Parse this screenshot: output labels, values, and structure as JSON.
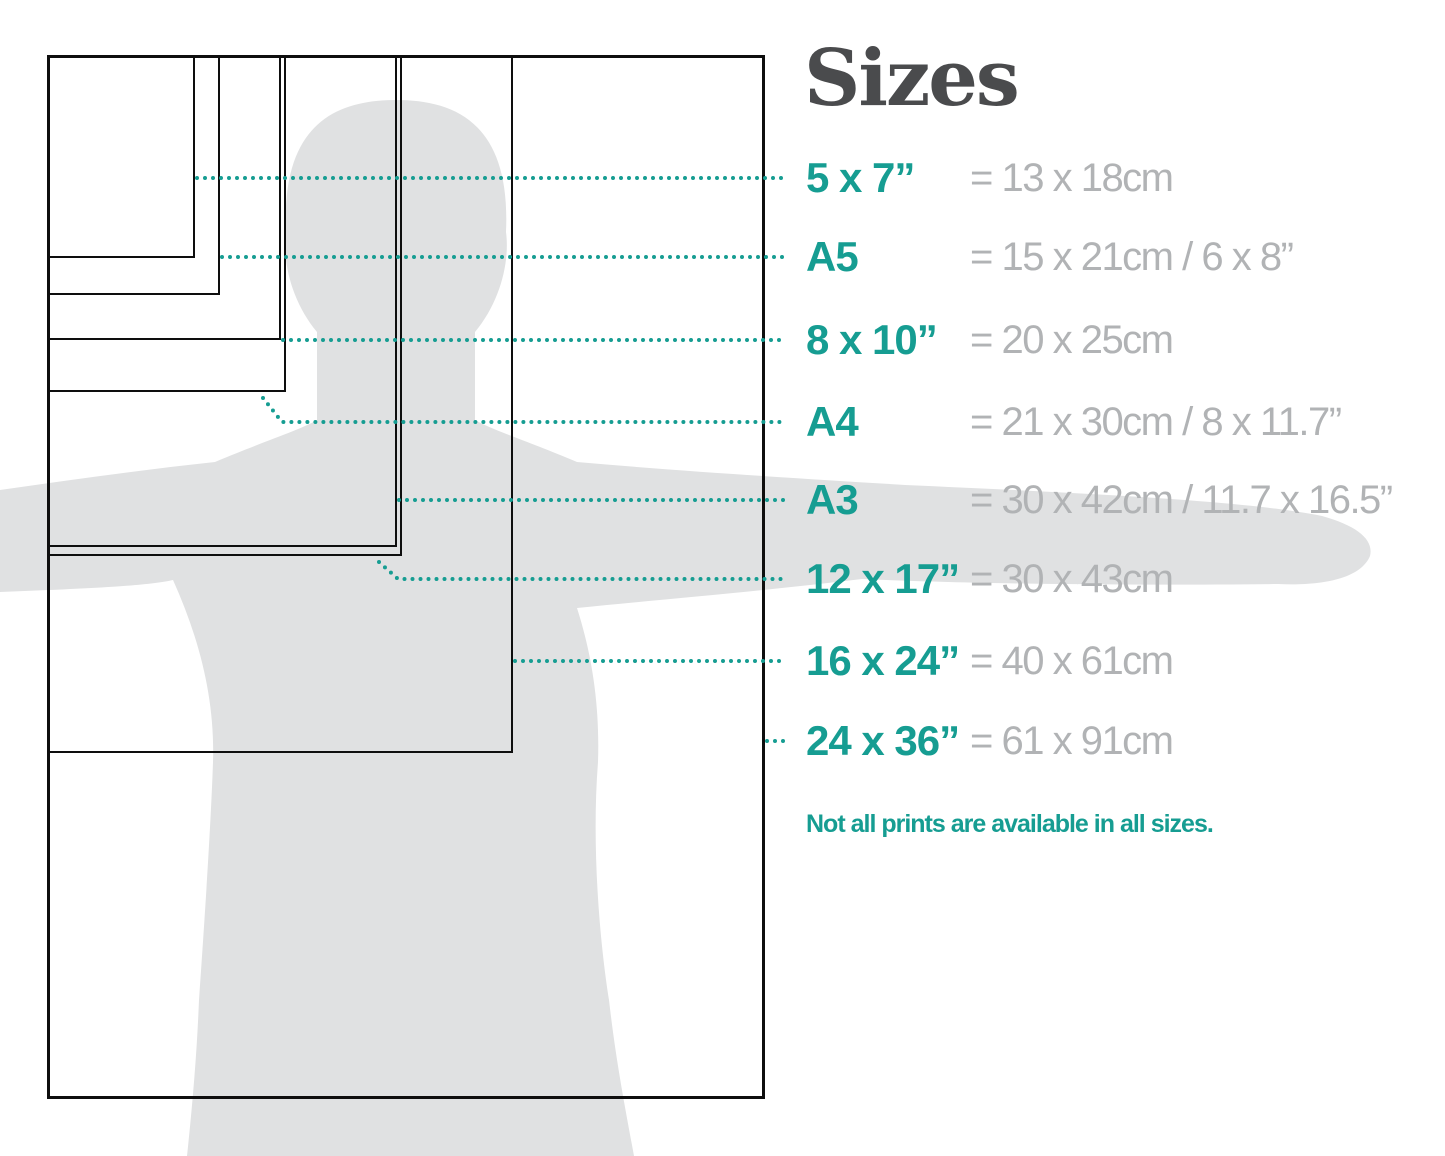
{
  "title": "Sizes",
  "note": "Not all prints are available in all sizes.",
  "colors": {
    "teal_accent": "#169d92",
    "value_gray": "#b1b3b5",
    "title_gray": "#4a4b4d",
    "silhouette_gray": "#e0e1e2",
    "rect_line": "#0e0e0e"
  },
  "sizes": [
    {
      "id": "5x7",
      "label": "5 x 7”",
      "value": "= 13 x 18cm",
      "rect": {
        "w": 148,
        "h": 203
      },
      "row_y": 178
    },
    {
      "id": "a5",
      "label": "A5",
      "value": "= 15 x 21cm / 6 x 8”",
      "rect": {
        "w": 173,
        "h": 240
      },
      "row_y": 257
    },
    {
      "id": "8x10",
      "label": "8 x 10”",
      "value": "= 20 x 25cm",
      "rect": {
        "w": 234,
        "h": 285
      },
      "row_y": 340
    },
    {
      "id": "a4",
      "label": "A4",
      "value": "= 21 x 30cm / 8 x 11.7”",
      "rect": {
        "w": 239,
        "h": 337
      },
      "row_y": 422,
      "leader_diagonal": true
    },
    {
      "id": "a3",
      "label": "A3",
      "value": "= 30 x 42cm / 11.7 x 16.5”",
      "rect": {
        "w": 350,
        "h": 492
      },
      "row_y": 500
    },
    {
      "id": "12x17",
      "label": "12 x 17”",
      "value": "= 30 x 43cm",
      "rect": {
        "w": 355,
        "h": 501
      },
      "row_y": 579,
      "leader_diagonal": true
    },
    {
      "id": "16x24",
      "label": "16 x 24”",
      "value": "= 40 x 61cm",
      "rect": {
        "w": 466,
        "h": 698
      },
      "row_y": 661
    },
    {
      "id": "24x36",
      "label": "24 x 36”",
      "value": "= 61 x 91cm",
      "rect": {
        "w": 718,
        "h": 1044
      },
      "row_y": 741,
      "outer": true
    }
  ],
  "layout": {
    "rect_origin_x": 47,
    "rect_origin_y": 55,
    "leader_end_x": 786
  }
}
